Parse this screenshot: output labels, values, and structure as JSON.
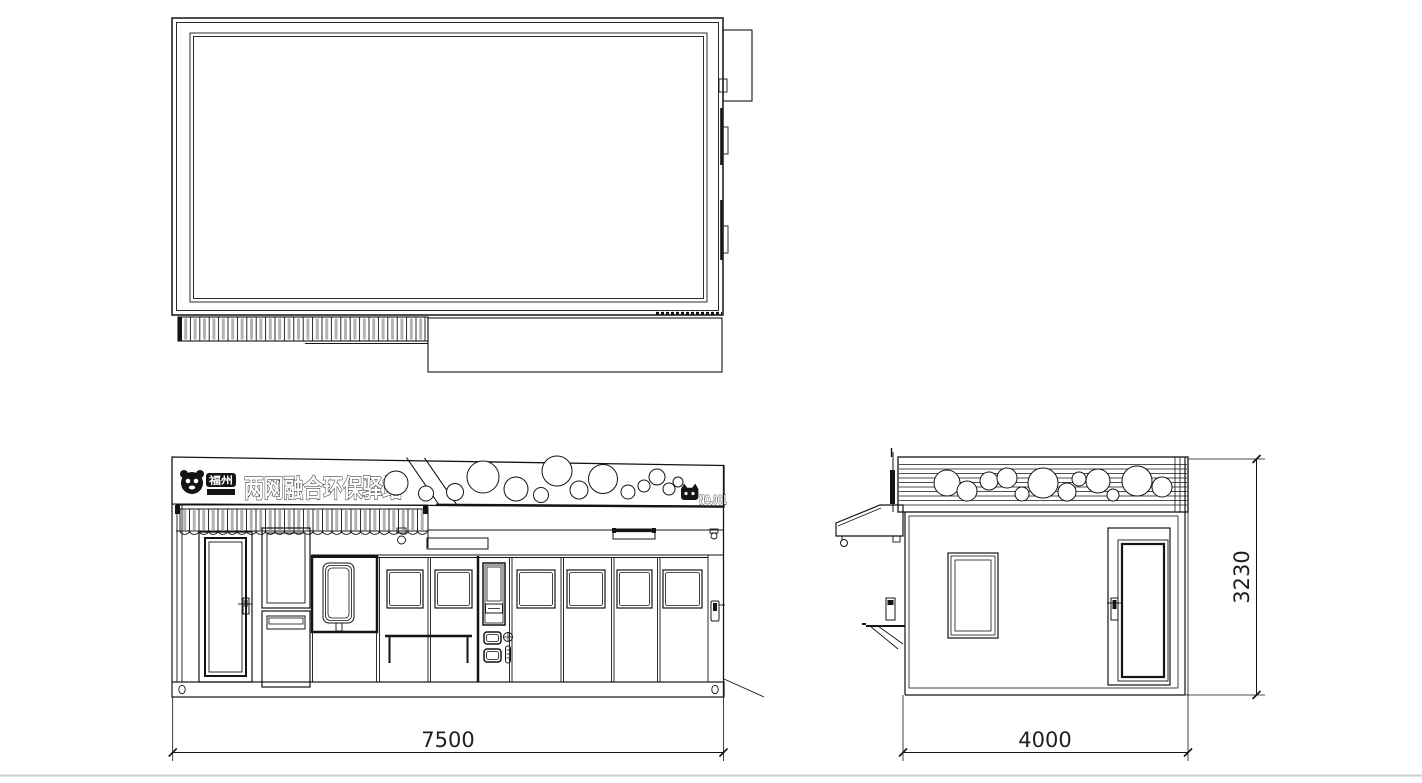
{
  "signage": {
    "logo_badge_text": "福州",
    "title": "两网融合环保驿站",
    "unit_number": "NO.001"
  },
  "dimensions": {
    "front_width": "7500",
    "side_depth": "4000",
    "height": "3230"
  },
  "colors": {
    "line": "#141414",
    "slat_gray": "#b3b3b3",
    "background": "#ffffff",
    "divider": "#cfcfcf"
  }
}
